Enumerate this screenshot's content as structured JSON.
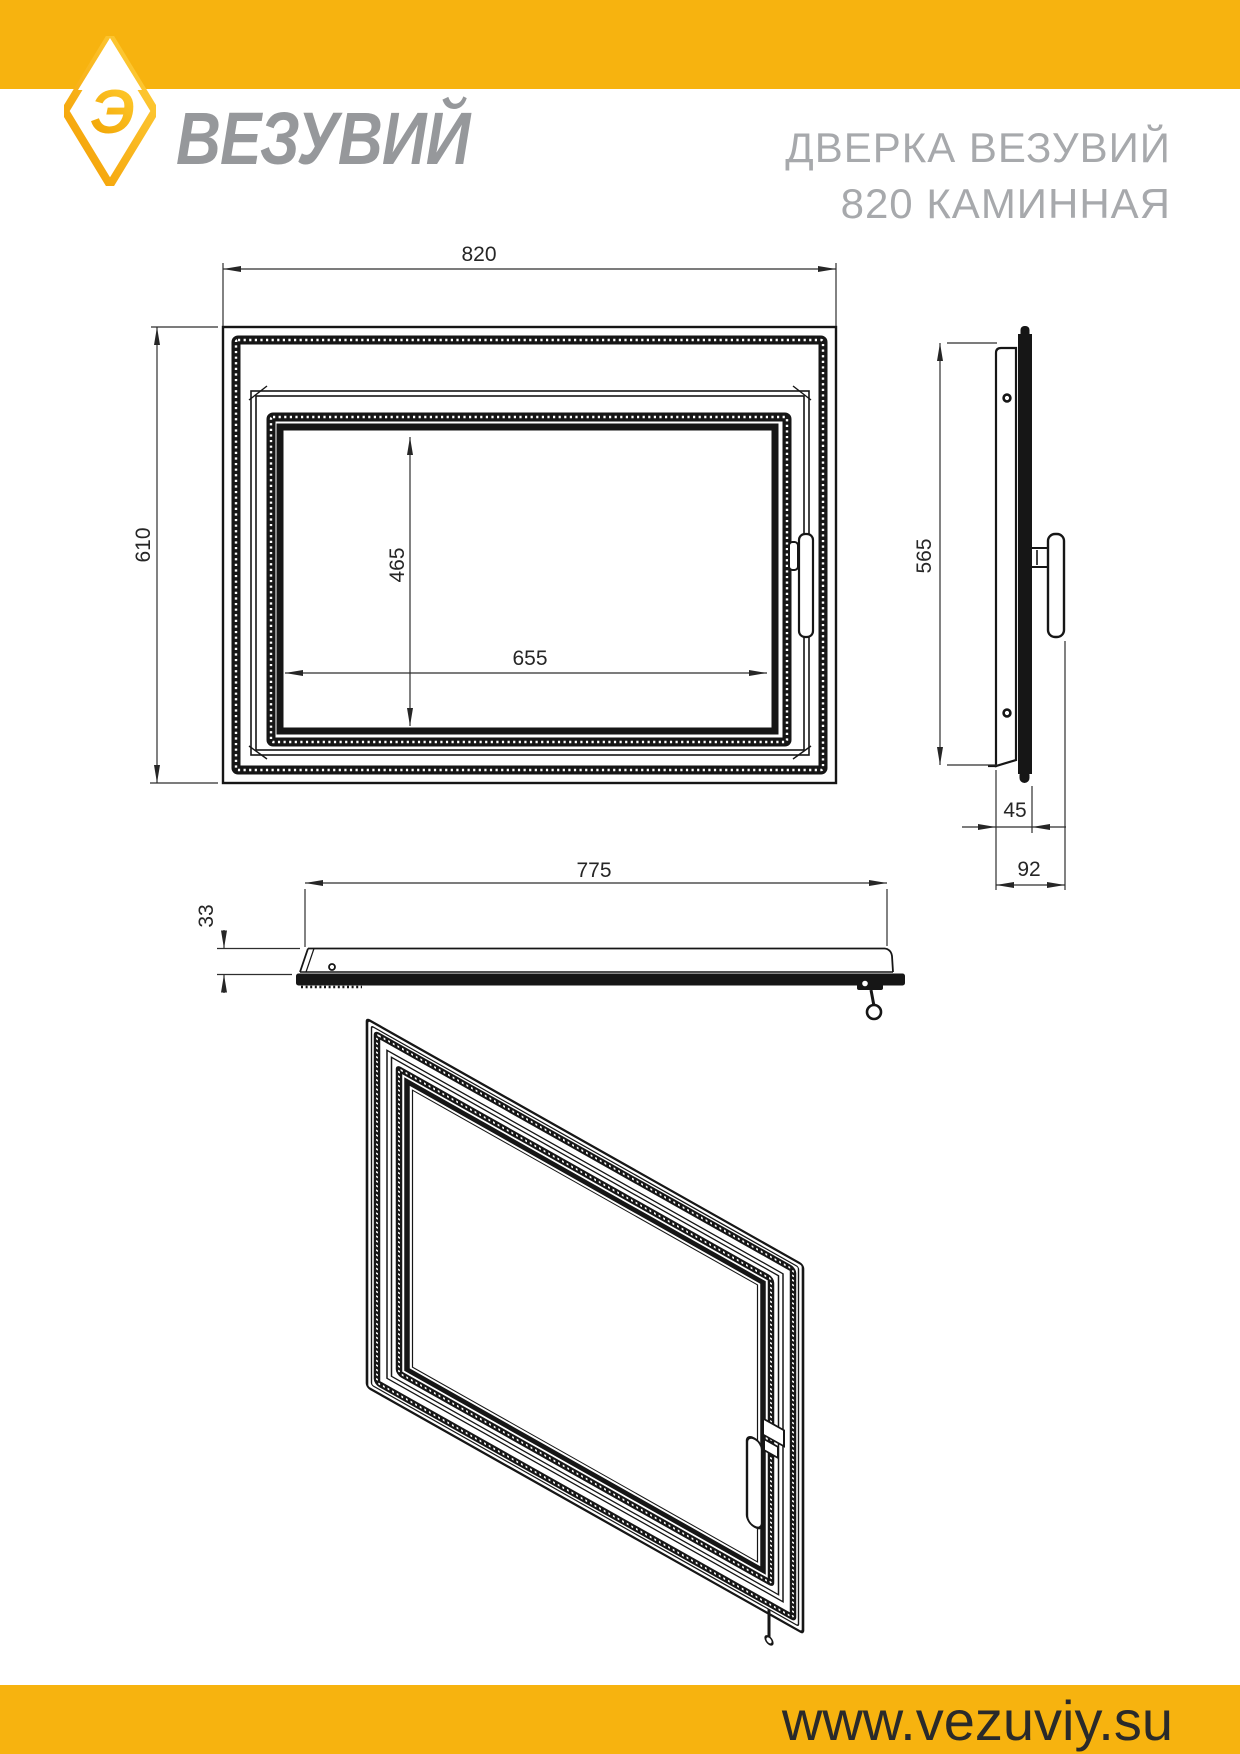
{
  "header": {
    "logo_text": "ВЕЗУВИЙ",
    "logo_glyph": "Э",
    "title_line1": "ДВЕРКА ВЕЗУВИЙ",
    "title_line2": "820 КАМИННАЯ"
  },
  "footer": {
    "url": "www.vezuviy.su"
  },
  "colors": {
    "brand_yellow": "#F7B30F",
    "logo_gradient_light": "#FFD23F",
    "logo_gradient_dark": "#F39C00",
    "logo_text_gray": "#96989B",
    "title_gray": "#A7A9AC",
    "drawing_line": "#161616",
    "dimension_text": "#262626",
    "url_text": "#2A2A2A"
  },
  "drawing": {
    "front_view": {
      "width_label": "820",
      "height_label": "610",
      "glass_width_label": "655",
      "glass_height_label": "465"
    },
    "side_view": {
      "height_label": "565",
      "frame_depth_label": "45",
      "total_depth_label": "92"
    },
    "top_view": {
      "width_label": "775",
      "thickness_label": "33"
    }
  }
}
